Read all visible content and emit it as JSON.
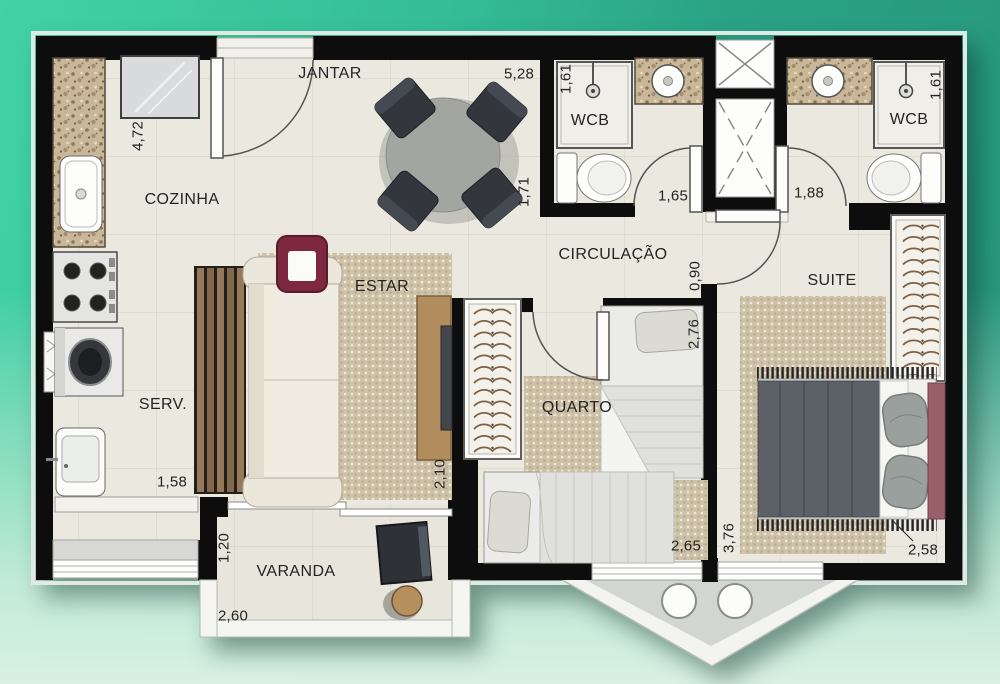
{
  "labels": {
    "jantar": "JANTAR",
    "cozinha": "COZINHA",
    "wcb_left": "WCB",
    "wcb_right": "WCB",
    "circulacao": "CIRCULAÇÃO",
    "estar": "ESTAR",
    "suite": "SUITE",
    "quarto": "QUARTO",
    "serv": "SERV.",
    "varanda": "VARANDA"
  },
  "dimensions": {
    "jantar_width": "5,28",
    "jantar_depth": "1,71",
    "cozinha_depth": "4,72",
    "wcb_left_depth": "1,61",
    "wcb_left_entry": "1,65",
    "wcb_right_depth": "1,61",
    "wcb_right_entry": "1,88",
    "circulacao_width": "0,90",
    "quarto_bed_length": "2,76",
    "quarto_width": "2,65",
    "estar_tv_wall": "2,10",
    "serv_width": "1,58",
    "suite_depth": "3,76",
    "suite_bed_width": "2,58",
    "varanda_depth": "1,20",
    "varanda_width": "2,60"
  },
  "colors": {
    "background_top_left": "#41d3a4",
    "background_top_right": "#27957c",
    "background_bottom": "#d9f1e3",
    "wall": "#0d0d0d",
    "floor": "#eae8df",
    "granite": "#c9b79a",
    "rug": "#cdc1a8",
    "wood": "#b18c5d",
    "accent_maroon": "#7e2840",
    "suite_bedding": "#5b6167",
    "terrace_floor": "#d2d5d1"
  }
}
